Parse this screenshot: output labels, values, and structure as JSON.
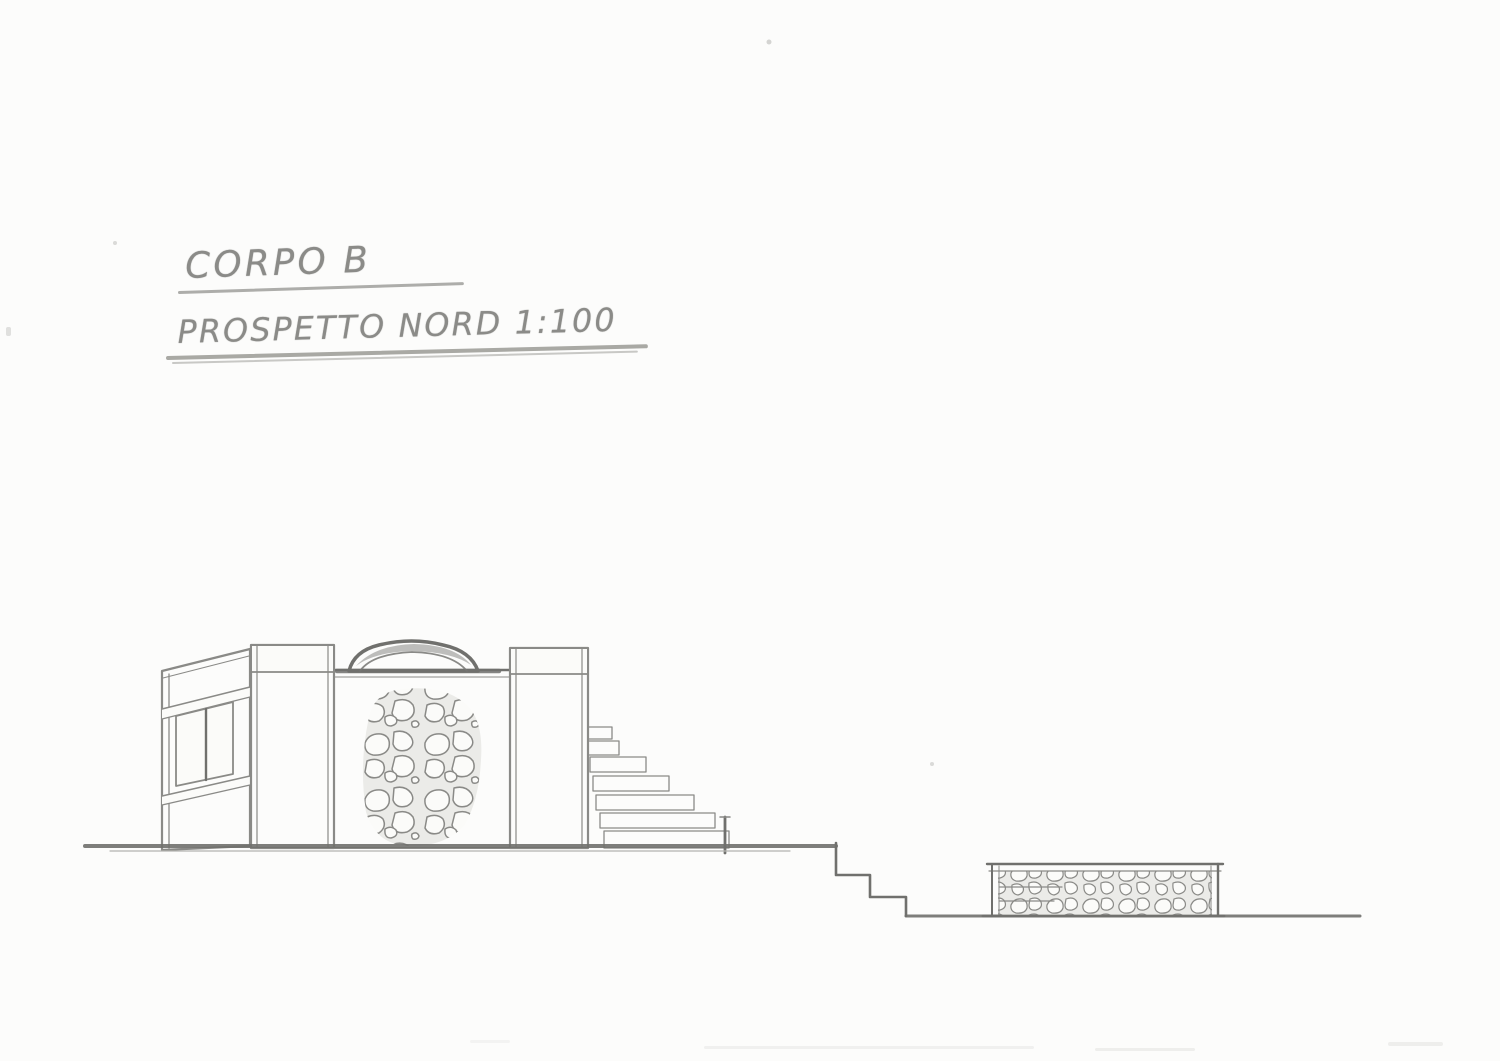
{
  "titles": {
    "line1": "CORPO B",
    "line2": "PROSPETTO NORD 1:100"
  },
  "drawing": {
    "body_label": "CORPO B",
    "view_label": "PROSPETTO NORD",
    "scale_label": "1:100"
  },
  "colors": {
    "paper": "#fcfcfb",
    "pencil": "#8a8a87",
    "pencil_dark": "#70706d",
    "pencil_light": "#b3b3b0",
    "mortar": "#ebebe8",
    "stone_fill": "#fbfbf9",
    "wall_fill": "#f4f4f1"
  }
}
